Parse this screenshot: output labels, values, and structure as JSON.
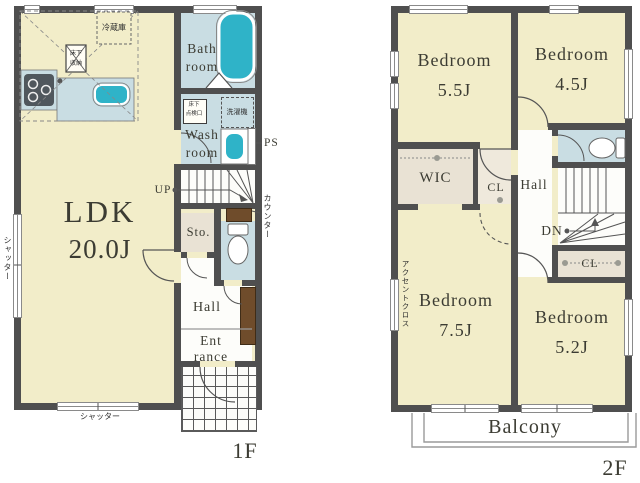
{
  "title": "floor-plan",
  "colors": {
    "wall": "#4f4f4f",
    "floor": "#f2edc9",
    "wet": "#c9dde3",
    "fixture": "#2fb3c8",
    "storage": "#e9e2d4",
    "storage_light": "#efe9dc",
    "wood": "#6f4c2b"
  },
  "floor1": {
    "floor_label": "1F",
    "ldk_name": "LDK",
    "ldk_size": "20.0J",
    "bath_l1": "Bath",
    "bath_l2": "room",
    "wash_l1": "Wash",
    "wash_l2": "room",
    "washer": "洗濯機",
    "inspect_l1": "床下",
    "inspect_l2": "点検口",
    "fridge": "冷蔵庫",
    "floorstor_l1": "床下",
    "floorstor_l2": "収納",
    "up": "UP",
    "ps": "PS",
    "sto": "Sto.",
    "counter": "カウンター",
    "hall": "Hall",
    "ent_l1": "Ent",
    "ent_l2": "rance",
    "shutter_left": "シャッター",
    "shutter_bottom": "シャッター"
  },
  "floor2": {
    "floor_label": "2F",
    "b1_name": "Bedroom",
    "b1_size": "5.5J",
    "b2_name": "Bedroom",
    "b2_size": "4.5J",
    "b3_name": "Bedroom",
    "b3_size": "7.5J",
    "b4_name": "Bedroom",
    "b4_size": "5.2J",
    "wic": "WIC",
    "cl_upper": "CL",
    "cl_lower": "CL",
    "hall": "Hall",
    "dn": "DN",
    "accent": "アクセントクロス",
    "balcony": "Balcony"
  }
}
